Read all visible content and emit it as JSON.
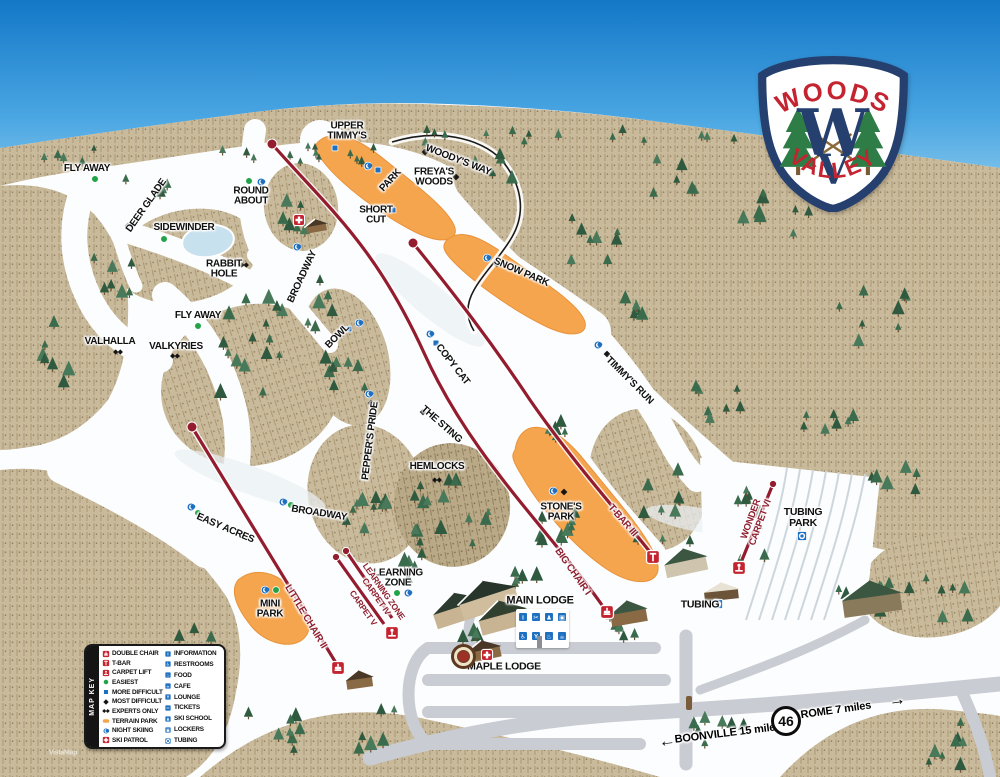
{
  "map_title": "Woods Valley Trail Map",
  "credit": "VistaMap",
  "logo": {
    "top": "WOODS",
    "bottom": "VALLEY",
    "monogram_w": "W",
    "monogram_v": "V"
  },
  "colors": {
    "sky_top": "#1478c8",
    "sky_bottom": "#c2e6f7",
    "snow": "#fcfdfe",
    "forest": "#c9ba9b",
    "forest_dark": "#b9a987",
    "lift_line": "#931c2e",
    "terrain_park": "#f5a54d",
    "easiest": "#23a348",
    "more_difficult": "#1d6fc0",
    "night_skiing": "#1d6fc0",
    "ski_patrol": "#c42330",
    "road": "#c9ccd2",
    "pond": "#c7e2ee",
    "tree": "#35624a",
    "logo_navy": "#25406e",
    "logo_red": "#c42330"
  },
  "legend": {
    "title": "MAP KEY",
    "left": [
      {
        "icon": "lift-chair",
        "label": "DOUBLE CHAIR"
      },
      {
        "icon": "lift-tbar",
        "label": "T-BAR"
      },
      {
        "icon": "lift-carpet",
        "label": "CARPET LIFT"
      },
      {
        "icon": "easiest",
        "label": "EASIEST"
      },
      {
        "icon": "more-difficult",
        "label": "MORE DIFFICULT"
      },
      {
        "icon": "most-difficult",
        "label": "MOST DIFFICULT"
      },
      {
        "icon": "experts-only",
        "label": "EXPERTS ONLY"
      },
      {
        "icon": "terrain-park",
        "label": "TERRAIN PARK"
      },
      {
        "icon": "night-skiing",
        "label": "NIGHT SKIING"
      },
      {
        "icon": "ski-patrol",
        "label": "SKI PATROL"
      }
    ],
    "right": [
      {
        "icon": "information",
        "label": "INFORMATION"
      },
      {
        "icon": "restrooms",
        "label": "RESTROOMS"
      },
      {
        "icon": "food",
        "label": "FOOD"
      },
      {
        "icon": "cafe",
        "label": "CAFE"
      },
      {
        "icon": "lounge",
        "label": "LOUNGE"
      },
      {
        "icon": "tickets",
        "label": "TICKETS"
      },
      {
        "icon": "ski-school",
        "label": "SKI SCHOOL"
      },
      {
        "icon": "lockers",
        "label": "LOCKERS"
      },
      {
        "icon": "tubing",
        "label": "TUBING"
      }
    ]
  },
  "labels": [
    {
      "id": "fly-away-1",
      "text": "FLY AWAY",
      "x": 87,
      "y": 169
    },
    {
      "id": "deer-glade",
      "text": "DEER GLADE",
      "x": 147,
      "y": 206,
      "rot": -55
    },
    {
      "id": "round-about",
      "text": "ROUND\nABOUT",
      "x": 251,
      "y": 197
    },
    {
      "id": "sidewinder",
      "text": "SIDEWINDER",
      "x": 184,
      "y": 228
    },
    {
      "id": "rabbit-hole",
      "text": "RABBIT\nHOLE",
      "x": 224,
      "y": 270
    },
    {
      "id": "broadway-upper",
      "text": "BROADWAY",
      "x": 303,
      "y": 277,
      "rot": -65
    },
    {
      "id": "valhalla",
      "text": "VALHALLA",
      "x": 110,
      "y": 342
    },
    {
      "id": "valkyries",
      "text": "VALKYRIES",
      "x": 176,
      "y": 347
    },
    {
      "id": "fly-away-2",
      "text": "FLY AWAY",
      "x": 198,
      "y": 316
    },
    {
      "id": "upper-timmys",
      "text": "UPPER\nTIMMY'S",
      "x": 347,
      "y": 132
    },
    {
      "id": "park",
      "text": "PARK",
      "x": 391,
      "y": 181,
      "rot": -47
    },
    {
      "id": "woodys-way",
      "text": "WOODY'S WAY",
      "x": 458,
      "y": 161,
      "rot": 21
    },
    {
      "id": "freyas-woods",
      "text": "FREYA'S\nWOODS",
      "x": 434,
      "y": 178
    },
    {
      "id": "short-cut",
      "text": "SHORT\nCUT",
      "x": 376,
      "y": 216
    },
    {
      "id": "snow-park",
      "text": "SNOW PARK",
      "x": 521,
      "y": 273,
      "rot": 23
    },
    {
      "id": "timmys-run",
      "text": "TIMMY'S RUN",
      "x": 629,
      "y": 381,
      "rot": 45
    },
    {
      "id": "bowl",
      "text": "BOWL",
      "x": 338,
      "y": 337,
      "rot": -45
    },
    {
      "id": "copy-cat",
      "text": "COPY CAT",
      "x": 452,
      "y": 365,
      "rot": 52
    },
    {
      "id": "peppers-pride",
      "text": "PEPPER'S PRIDE",
      "x": 371,
      "y": 441,
      "rot": -83
    },
    {
      "id": "the-sting",
      "text": "THE STING",
      "x": 441,
      "y": 425,
      "rot": 41
    },
    {
      "id": "hemlocks",
      "text": "HEMLOCKS",
      "x": 437,
      "y": 467
    },
    {
      "id": "stones-park",
      "text": "STONE'S\nPARK",
      "x": 561,
      "y": 513
    },
    {
      "id": "broadway-lower",
      "text": "BROADWAY",
      "x": 319,
      "y": 514,
      "rot": 9
    },
    {
      "id": "easy-acres",
      "text": "EASY ACRES",
      "x": 225,
      "y": 529,
      "rot": 23
    },
    {
      "id": "mini-park",
      "text": "MINI\nPARK",
      "x": 270,
      "y": 610
    },
    {
      "id": "learning-zone",
      "text": "LEARNING\nZONE",
      "x": 398,
      "y": 579
    },
    {
      "id": "main-lodge",
      "text": "MAIN LODGE",
      "x": 540,
      "y": 601,
      "size": 11
    },
    {
      "id": "maple-lodge",
      "text": "MAPLE LODGE",
      "x": 504,
      "y": 667,
      "size": 10.5
    },
    {
      "id": "tubing-park",
      "text": "TUBING\nPARK",
      "x": 803,
      "y": 518,
      "size": 10.5
    },
    {
      "id": "tubing-area",
      "text": "TUBING",
      "x": 700,
      "y": 605,
      "size": 10.5
    },
    {
      "id": "big-chair-i",
      "text": "BIG CHAIR I",
      "x": 572,
      "y": 572,
      "rot": 55,
      "cls": "lift"
    },
    {
      "id": "t-bar-iii",
      "text": "T-BAR III",
      "x": 622,
      "y": 521,
      "rot": 49,
      "cls": "lift"
    },
    {
      "id": "little-chair-ii",
      "text": "LITTLE CHAIR II",
      "x": 305,
      "y": 617,
      "rot": 59,
      "cls": "lift"
    },
    {
      "id": "learning-zone-carpet-iv",
      "text": "LEARNING ZONE\nCARPET IV",
      "x": 380,
      "y": 594,
      "rot": 55,
      "cls": "lift",
      "size": 8.5
    },
    {
      "id": "carpet-v",
      "text": "CARPET V",
      "x": 363,
      "y": 608,
      "rot": 55,
      "cls": "lift",
      "size": 8.5
    },
    {
      "id": "wonder-carpet-vi",
      "text": "WONDER\nCARPET VI",
      "x": 756,
      "y": 521,
      "rot": -70,
      "cls": "lift",
      "size": 9.5
    },
    {
      "id": "boonville",
      "text": "BOONVILLE 15 miles",
      "x": 728,
      "y": 734,
      "rot": -7,
      "cls": "road",
      "size": 11
    },
    {
      "id": "rome",
      "text": "ROME 7 miles",
      "x": 836,
      "y": 711,
      "rot": -8,
      "cls": "road",
      "size": 11
    },
    {
      "id": "arrow-left",
      "text": "←",
      "x": 667,
      "y": 741,
      "rot": -7,
      "cls": "road",
      "size": 17
    },
    {
      "id": "arrow-right",
      "text": "→",
      "x": 897,
      "y": 700,
      "rot": -8,
      "cls": "road",
      "size": 17
    }
  ],
  "markers": [
    {
      "type": "easiest",
      "x": 95,
      "y": 179
    },
    {
      "type": "easiest",
      "x": 164,
      "y": 239
    },
    {
      "type": "easiest",
      "x": 311,
      "y": 256
    },
    {
      "type": "easiest",
      "x": 198,
      "y": 326
    },
    {
      "type": "easiest",
      "x": 249,
      "y": 181
    },
    {
      "type": "easiest",
      "x": 291,
      "y": 505
    },
    {
      "type": "easiest",
      "x": 198,
      "y": 513
    },
    {
      "type": "easiest",
      "x": 276,
      "y": 590
    },
    {
      "type": "easiest",
      "x": 397,
      "y": 593
    },
    {
      "type": "night-skiing",
      "x": 261,
      "y": 182
    },
    {
      "type": "night-skiing",
      "x": 297,
      "y": 247
    },
    {
      "type": "night-skiing",
      "x": 368,
      "y": 166
    },
    {
      "type": "night-skiing",
      "x": 487,
      "y": 258
    },
    {
      "type": "night-skiing",
      "x": 598,
      "y": 345
    },
    {
      "type": "night-skiing",
      "x": 359,
      "y": 323
    },
    {
      "type": "night-skiing",
      "x": 430,
      "y": 334
    },
    {
      "type": "night-skiing",
      "x": 369,
      "y": 394
    },
    {
      "type": "night-skiing",
      "x": 553,
      "y": 491
    },
    {
      "type": "night-skiing",
      "x": 283,
      "y": 502
    },
    {
      "type": "night-skiing",
      "x": 191,
      "y": 507
    },
    {
      "type": "night-skiing",
      "x": 265,
      "y": 590
    },
    {
      "type": "night-skiing",
      "x": 408,
      "y": 593
    },
    {
      "type": "more-difficult",
      "x": 335,
      "y": 148
    },
    {
      "type": "more-difficult",
      "x": 378,
      "y": 170
    },
    {
      "type": "more-difficult",
      "x": 393,
      "y": 210
    },
    {
      "type": "more-difficult",
      "x": 349,
      "y": 329
    },
    {
      "type": "more-difficult",
      "x": 436,
      "y": 343
    },
    {
      "type": "most-difficult",
      "x": 128,
      "y": 226
    },
    {
      "type": "most-difficult",
      "x": 425,
      "y": 152
    },
    {
      "type": "most-difficult",
      "x": 456,
      "y": 177
    },
    {
      "type": "most-difficult",
      "x": 497,
      "y": 264
    },
    {
      "type": "most-difficult",
      "x": 607,
      "y": 354
    },
    {
      "type": "most-difficult",
      "x": 371,
      "y": 403
    },
    {
      "type": "most-difficult",
      "x": 423,
      "y": 412
    },
    {
      "type": "most-difficult",
      "x": 564,
      "y": 492
    },
    {
      "type": "experts-only",
      "x": 244,
      "y": 265
    },
    {
      "type": "experts-only",
      "x": 118,
      "y": 352
    },
    {
      "type": "experts-only",
      "x": 175,
      "y": 356
    },
    {
      "type": "experts-only",
      "x": 437,
      "y": 480
    },
    {
      "type": "ski-patrol",
      "x": 299,
      "y": 220
    },
    {
      "type": "ski-patrol",
      "x": 487,
      "y": 655
    },
    {
      "type": "tubing",
      "x": 802,
      "y": 536
    },
    {
      "type": "tubing",
      "x": 718,
      "y": 604
    }
  ],
  "lifts": [
    {
      "id": "big-chair-1",
      "name": "BIG CHAIR I",
      "base_icon": "lift-chair",
      "base": [
        607,
        612
      ],
      "top_dot": [
        272,
        144
      ]
    },
    {
      "id": "t-bar-3",
      "name": "T-BAR III",
      "base_icon": "lift-tbar",
      "base": [
        653,
        557
      ],
      "top_dot": [
        413,
        243
      ]
    },
    {
      "id": "little-chair-2",
      "name": "LITTLE CHAIR II",
      "base_icon": "lift-chair",
      "base": [
        338,
        668
      ],
      "top_dot": [
        192,
        427
      ]
    },
    {
      "id": "carpet-4",
      "name": "LEARNING ZONE CARPET IV",
      "base_icon": "lift-carpet",
      "base": [
        392,
        633
      ],
      "top_dot": [
        336,
        557
      ]
    },
    {
      "id": "carpet-5",
      "name": "CARPET V",
      "top_dot": [
        346,
        551
      ]
    },
    {
      "id": "wonder-carpet-6",
      "name": "WONDER CARPET VI",
      "base_icon": "lift-carpet",
      "base": [
        739,
        568
      ],
      "top_dot": [
        773,
        484
      ]
    }
  ],
  "main_lodge": {
    "label": "MAIN LODGE",
    "amenities": [
      "information",
      "tickets",
      "ski-school",
      "lockers",
      "restrooms",
      "lounge",
      "food",
      "cafe"
    ]
  },
  "roads": {
    "boonville": "BOONVILLE 15 miles",
    "rome": "ROME 7 miles",
    "route": "46"
  }
}
